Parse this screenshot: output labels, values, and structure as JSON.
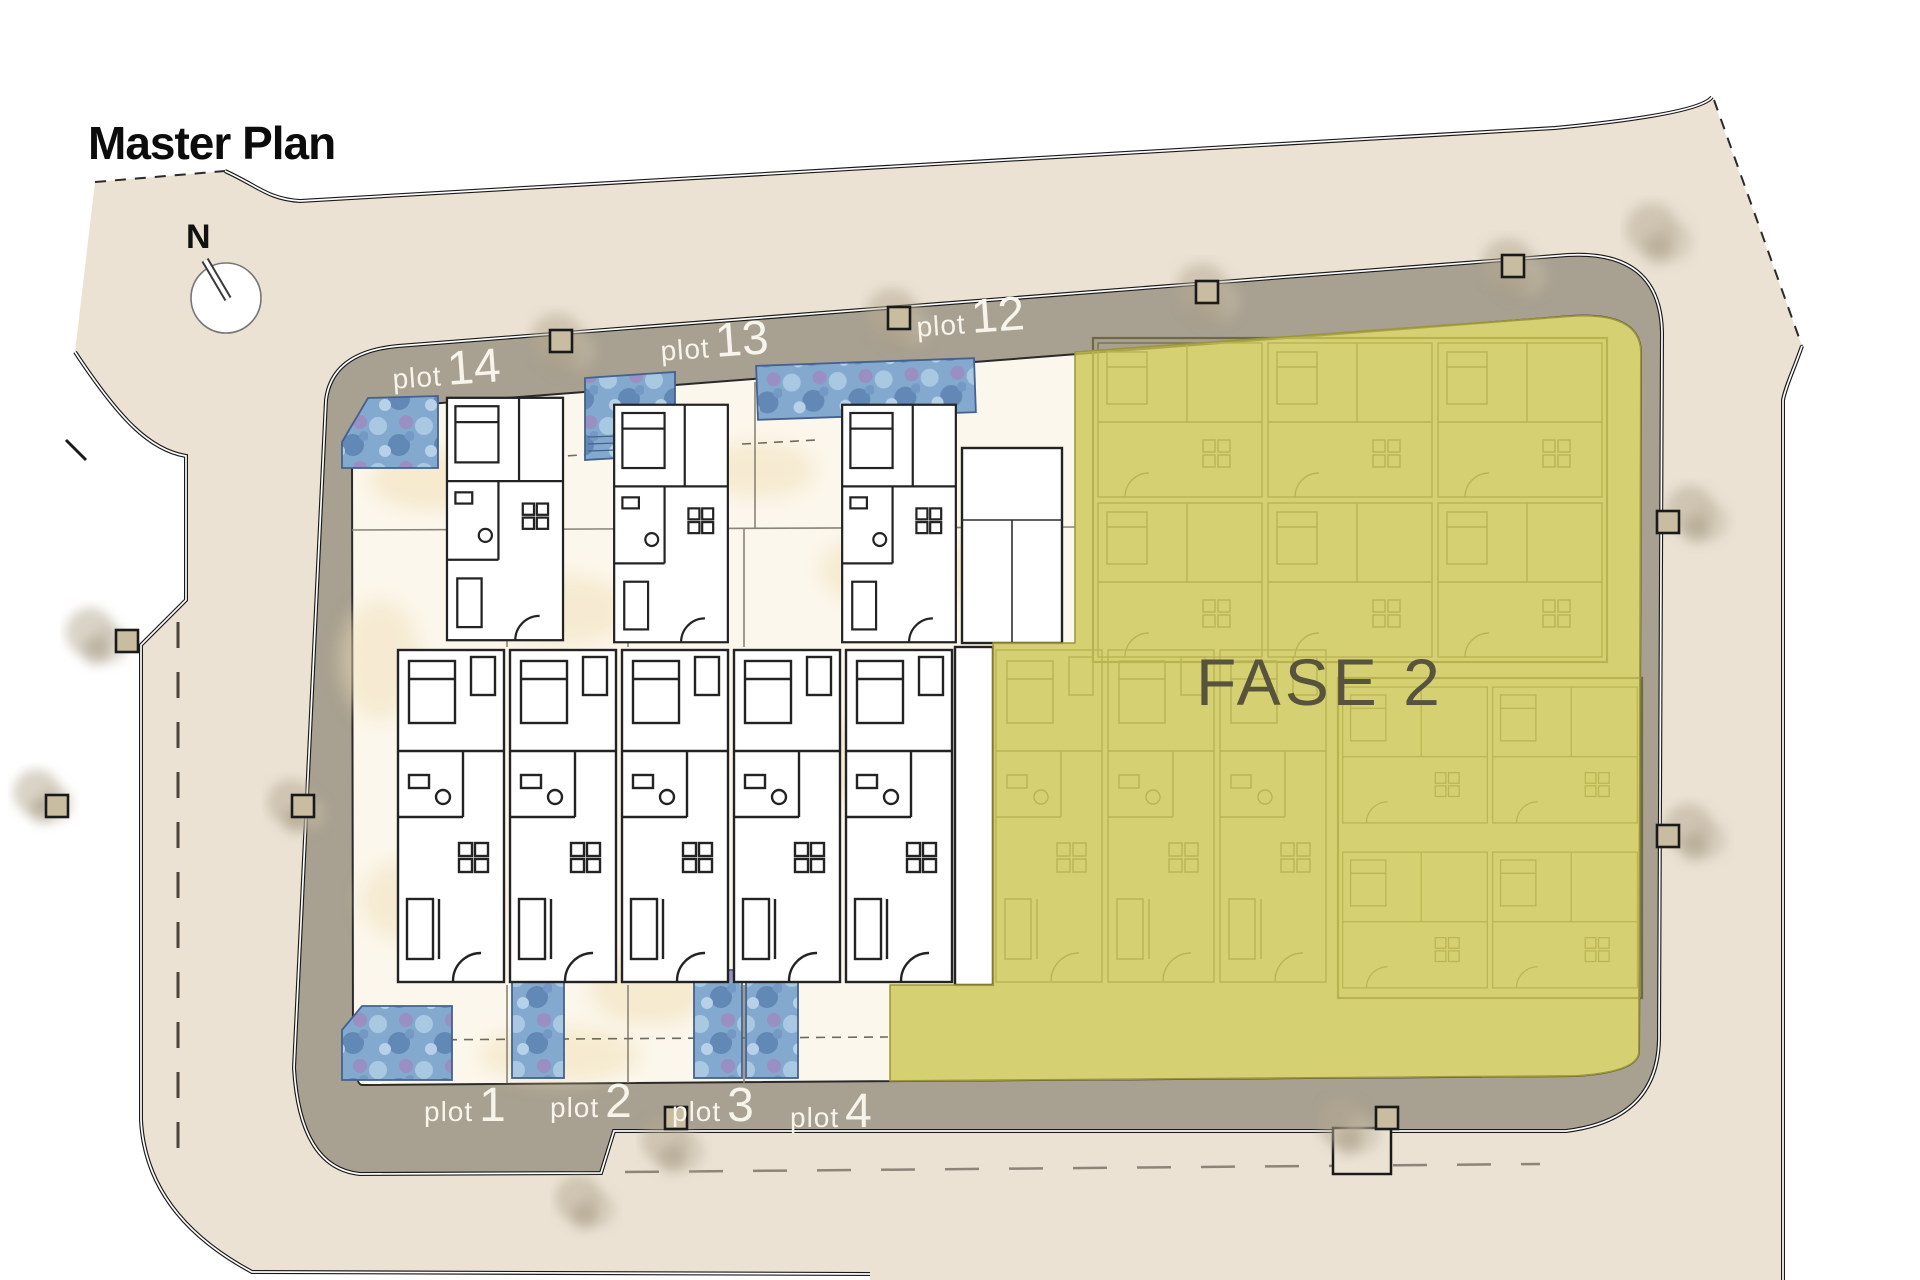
{
  "title": {
    "text": "Master Plan"
  },
  "compass": {
    "label": "N"
  },
  "phase": {
    "label": "FASE 2",
    "text_color": "#57533c",
    "fill_color": "#cbc654"
  },
  "plots": {
    "top": [
      {
        "word": "plot",
        "number": "14"
      },
      {
        "word": "plot",
        "number": "13"
      },
      {
        "word": "plot",
        "number": "12"
      }
    ],
    "bottom": [
      {
        "word": "plot",
        "number": "1"
      },
      {
        "word": "plot",
        "number": "2"
      },
      {
        "word": "plot",
        "number": "3"
      },
      {
        "word": "plot",
        "number": "4"
      }
    ]
  },
  "colors": {
    "site_beige": "#ebe2d4",
    "road_band_gray": "#a8a090",
    "plot_ground_cream": "#fcf7ec",
    "pool_blue": "#83a9ce",
    "phase_yellow": "#cbc654",
    "wall_black": "#1a1a1a",
    "label_white": "#f7f4ec"
  }
}
